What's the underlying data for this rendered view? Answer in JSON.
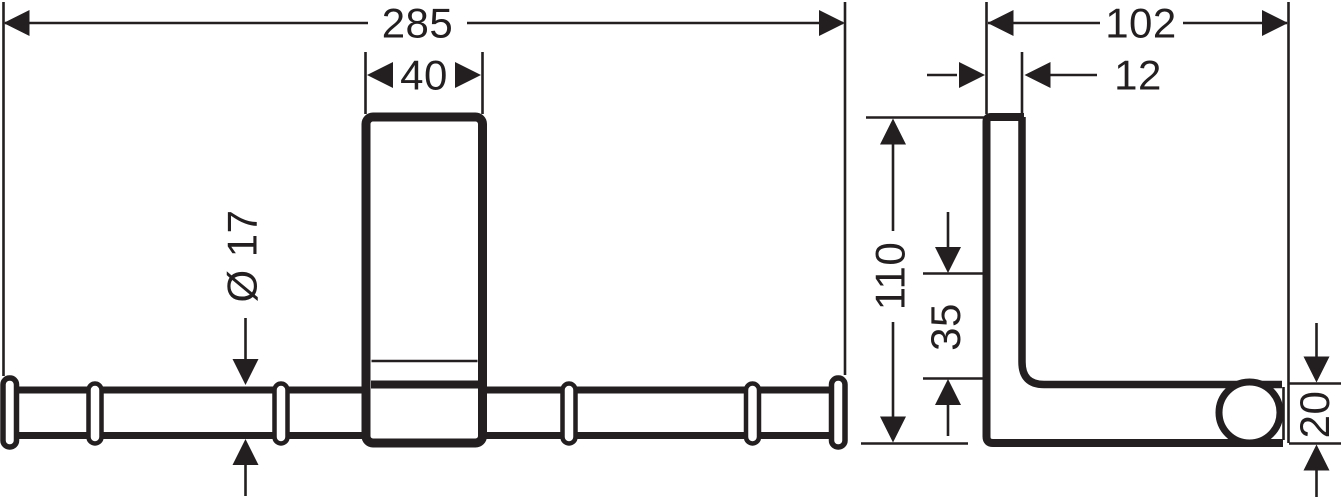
{
  "drawing": {
    "background_color": "#ffffff",
    "line_color": "#231f20",
    "front_view": {
      "overall_width": "285",
      "plate_width": "40",
      "bar_diameter": "Ø 17"
    },
    "side_view": {
      "overall_depth": "102",
      "plate_thickness": "12",
      "overall_height": "110",
      "arm_offset": "35",
      "end_height": "20"
    }
  }
}
